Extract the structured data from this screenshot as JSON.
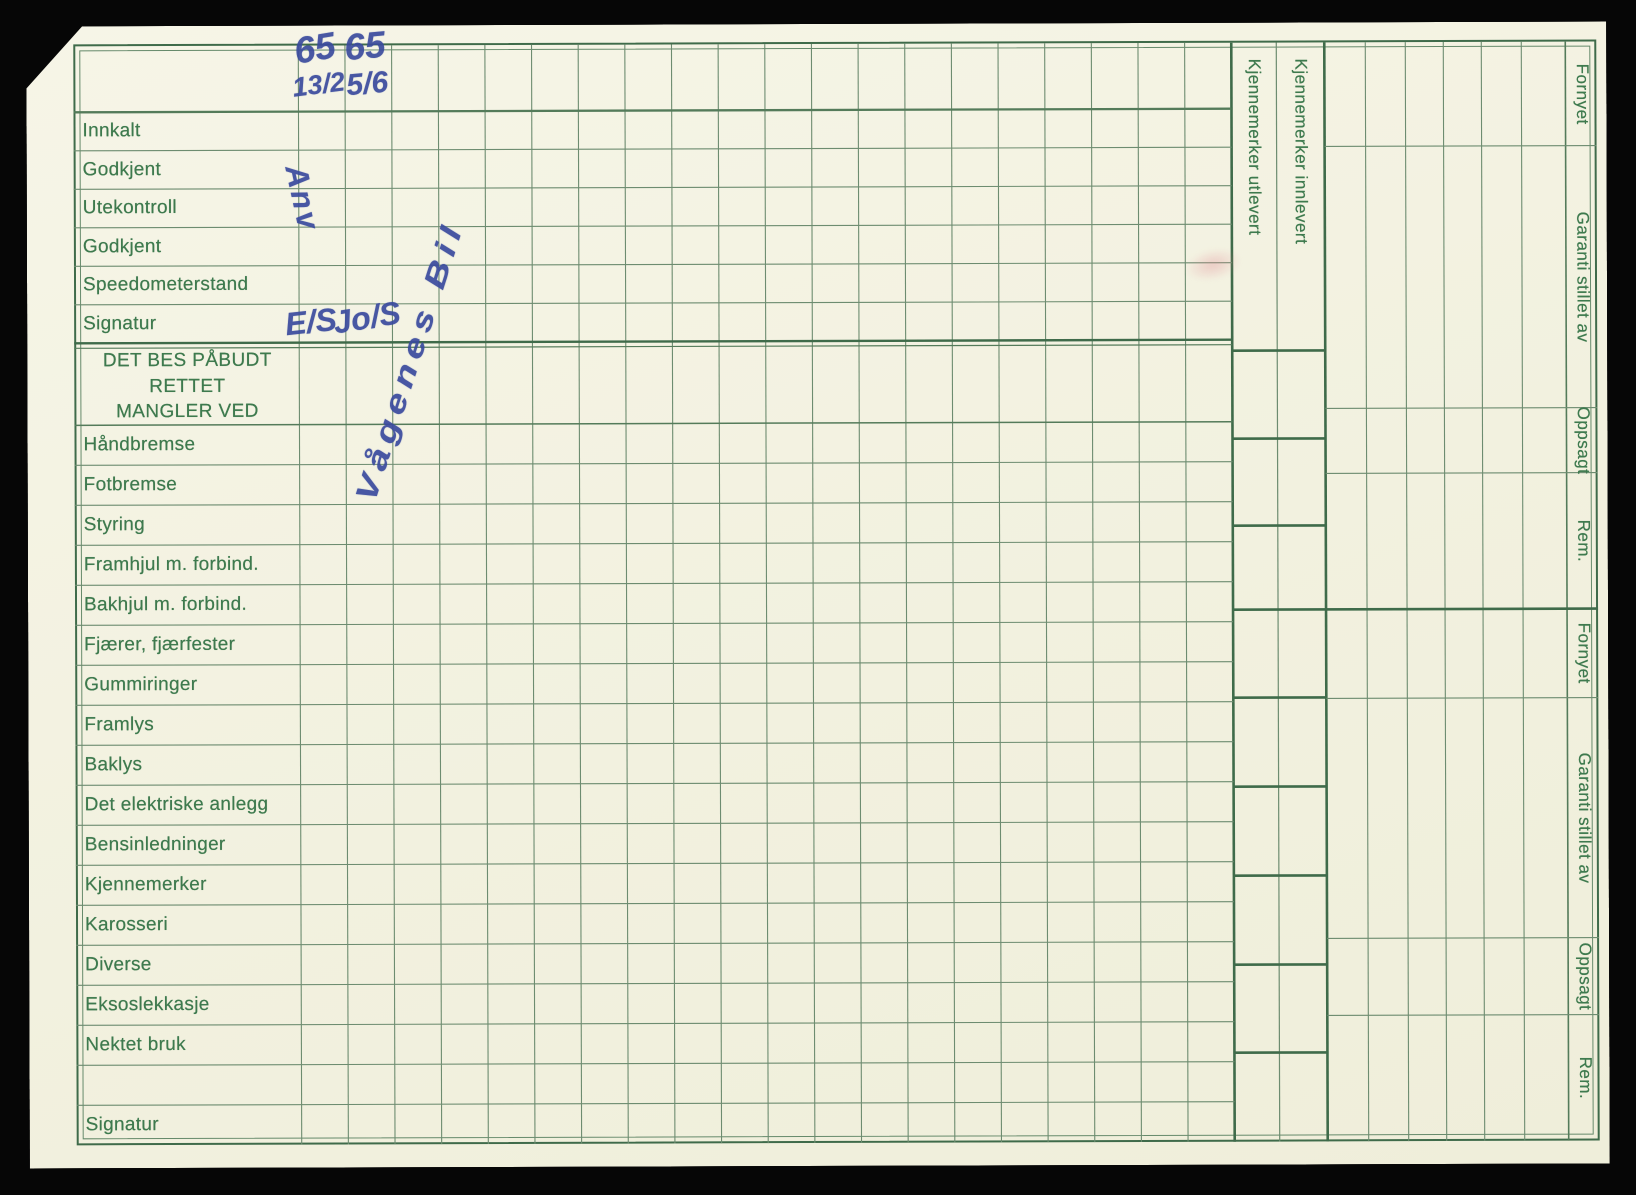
{
  "left_column": {
    "top_rows": [
      {
        "label": "Innkalt"
      },
      {
        "label": "Godkjent"
      },
      {
        "label": "Utekontroll"
      },
      {
        "label": "Godkjent"
      },
      {
        "label": "Speedometerstand"
      },
      {
        "label": "Signatur"
      }
    ],
    "section_header": {
      "line1": "DET BES PÅBUDT RETTET",
      "line2": "MANGLER VED"
    },
    "main_rows": [
      {
        "label": "Håndbremse"
      },
      {
        "label": "Fotbremse"
      },
      {
        "label": "Styring"
      },
      {
        "label": "Framhjul m. forbind."
      },
      {
        "label": "Bakhjul m. forbind."
      },
      {
        "label": "Fjærer, fjærfester"
      },
      {
        "label": "Gummiringer"
      },
      {
        "label": "Framlys"
      },
      {
        "label": "Baklys"
      },
      {
        "label": "Det elektriske anlegg"
      },
      {
        "label": "Bensinledninger"
      },
      {
        "label": "Kjennemerker"
      },
      {
        "label": "Karosseri"
      },
      {
        "label": "Diverse"
      },
      {
        "label": "Eksoslekkasje"
      },
      {
        "label": "Nektet bruk"
      },
      {
        "label": ""
      },
      {
        "label": "Signatur"
      }
    ]
  },
  "id_columns": {
    "utlevert_label": "Kjennemerker utlevert",
    "innlevert_label": "Kjennemerker innlevert"
  },
  "right_panel": {
    "top_labels": [
      "Fornyet",
      "Garanti stillet av",
      "Oppsagt",
      "Rem."
    ],
    "bottom_labels": [
      "Fornyet",
      "Garanti stillet av",
      "Oppsagt",
      "Rem."
    ]
  },
  "handwriting": {
    "col1_value": "65",
    "col2_value": "65",
    "col1_date": "13/2",
    "col2_date": "5/6",
    "col1_signature": "Anv",
    "col2_signature": "Vågenes Bil",
    "col1_initials": "E/S",
    "col2_initials": "Jo/S"
  },
  "colors": {
    "paper": "#f3f2e0",
    "line_green": "#6d8c70",
    "line_dark": "#3f6b4a",
    "text_green": "#3e7a4e",
    "ink_blue": "#3a4a9e"
  }
}
